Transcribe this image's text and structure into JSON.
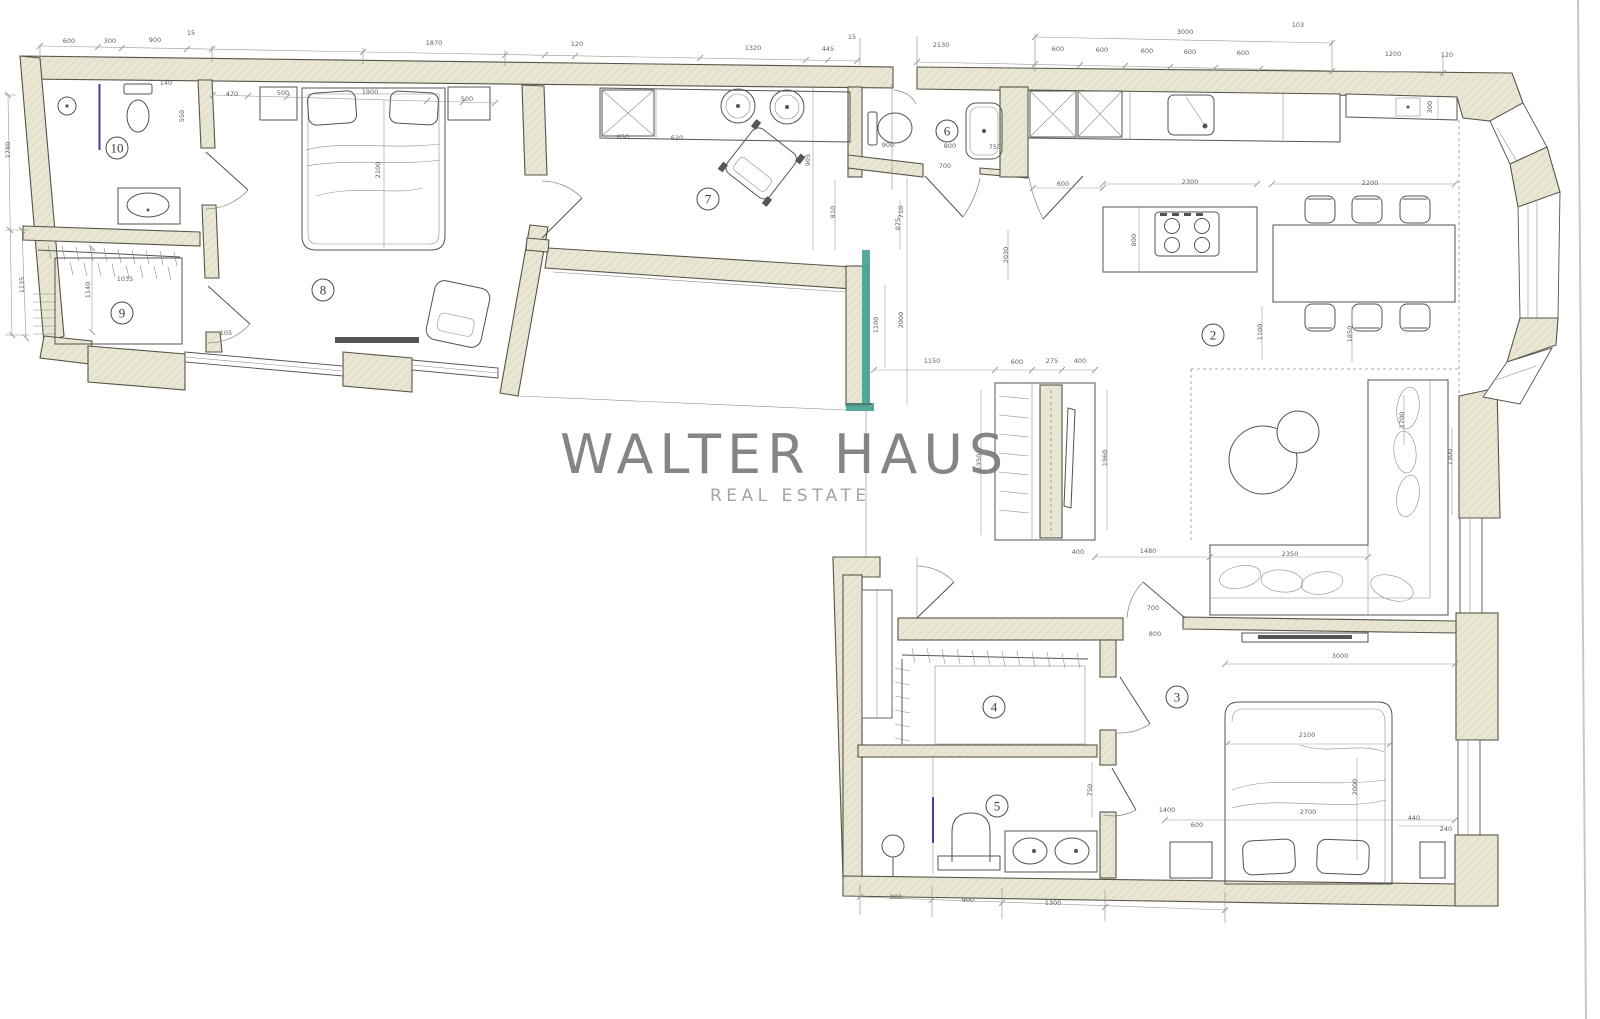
{
  "watermark": {
    "line1": "WALTER HAUS",
    "line2": "REAL ESTATE"
  },
  "colors": {
    "paper": "#ffffff",
    "wall_fill": "#e9e6d3",
    "wall_hatch": "#d5d0b4",
    "wall_stroke": "#56544a",
    "line": "#53534d",
    "thin_line": "#8e8e86",
    "dim_line": "#9b9b93",
    "dim_text": "#60605a",
    "teal_accent": "#43a18f",
    "blue_mark": "#3c3fae",
    "watermark_primary": "#7b7b7b",
    "watermark_secondary": "#9f9f9f",
    "page_edge": "#c9c9c4",
    "room_text": "#3c3c38"
  },
  "room_labels": [
    {
      "n": "10",
      "x": 117,
      "y": 148
    },
    {
      "n": "9",
      "x": 122,
      "y": 313
    },
    {
      "n": "8",
      "x": 323,
      "y": 290
    },
    {
      "n": "7",
      "x": 708,
      "y": 199
    },
    {
      "n": "6",
      "x": 947,
      "y": 131
    },
    {
      "n": "2",
      "x": 1213,
      "y": 335
    },
    {
      "n": "4",
      "x": 994,
      "y": 707
    },
    {
      "n": "5",
      "x": 997,
      "y": 806
    },
    {
      "n": "3",
      "x": 1177,
      "y": 697
    }
  ],
  "dimensions": [
    {
      "t": "600",
      "x": 69,
      "y": 43
    },
    {
      "t": "300",
      "x": 110,
      "y": 43
    },
    {
      "t": "900",
      "x": 155,
      "y": 42
    },
    {
      "t": "15",
      "x": 191,
      "y": 35
    },
    {
      "t": "1870",
      "x": 434,
      "y": 45
    },
    {
      "t": "120",
      "x": 577,
      "y": 46
    },
    {
      "t": "1320",
      "x": 753,
      "y": 50
    },
    {
      "t": "445",
      "x": 828,
      "y": 51
    },
    {
      "t": "15",
      "x": 852,
      "y": 39
    },
    {
      "t": "2130",
      "x": 941,
      "y": 47
    },
    {
      "t": "103",
      "x": 1298,
      "y": 27
    },
    {
      "t": "3000",
      "x": 1185,
      "y": 34
    },
    {
      "t": "600",
      "x": 1058,
      "y": 51
    },
    {
      "t": "600",
      "x": 1102,
      "y": 52
    },
    {
      "t": "600",
      "x": 1147,
      "y": 53
    },
    {
      "t": "600",
      "x": 1190,
      "y": 54
    },
    {
      "t": "600",
      "x": 1243,
      "y": 55
    },
    {
      "t": "1200",
      "x": 1393,
      "y": 56
    },
    {
      "t": "120",
      "x": 1447,
      "y": 57
    },
    {
      "t": "300",
      "x": 1432,
      "y": 107,
      "r": -90
    },
    {
      "t": "1780",
      "x": 10,
      "y": 150,
      "r": -90
    },
    {
      "t": "1135",
      "x": 24,
      "y": 285,
      "r": -90
    },
    {
      "t": "1140",
      "x": 90,
      "y": 290,
      "r": -90
    },
    {
      "t": "140",
      "x": 166,
      "y": 85
    },
    {
      "t": "550",
      "x": 184,
      "y": 116,
      "r": -90
    },
    {
      "t": "1035",
      "x": 125,
      "y": 281
    },
    {
      "t": "470",
      "x": 232,
      "y": 96
    },
    {
      "t": "500",
      "x": 283,
      "y": 95
    },
    {
      "t": "1900",
      "x": 370,
      "y": 94
    },
    {
      "t": "500",
      "x": 467,
      "y": 101
    },
    {
      "t": "2100",
      "x": 380,
      "y": 170,
      "r": -90
    },
    {
      "t": "105",
      "x": 226,
      "y": 335
    },
    {
      "t": "650",
      "x": 623,
      "y": 139
    },
    {
      "t": "620",
      "x": 677,
      "y": 140
    },
    {
      "t": "905",
      "x": 810,
      "y": 160,
      "r": -90
    },
    {
      "t": "810",
      "x": 835,
      "y": 212,
      "r": -90
    },
    {
      "t": "875",
      "x": 900,
      "y": 224,
      "r": -90
    },
    {
      "t": "900",
      "x": 888,
      "y": 147
    },
    {
      "t": "800",
      "x": 950,
      "y": 148
    },
    {
      "t": "750",
      "x": 995,
      "y": 149
    },
    {
      "t": "700",
      "x": 945,
      "y": 168
    },
    {
      "t": "2030",
      "x": 1008,
      "y": 255,
      "r": -90
    },
    {
      "t": "710",
      "x": 903,
      "y": 212,
      "r": -90
    },
    {
      "t": "2000",
      "x": 903,
      "y": 320,
      "r": -90
    },
    {
      "t": "1100",
      "x": 878,
      "y": 325,
      "r": -90
    },
    {
      "t": "1150",
      "x": 932,
      "y": 363
    },
    {
      "t": "600",
      "x": 1017,
      "y": 364
    },
    {
      "t": "275",
      "x": 1052,
      "y": 363
    },
    {
      "t": "400",
      "x": 1080,
      "y": 363
    },
    {
      "t": "1950",
      "x": 981,
      "y": 462,
      "r": -90
    },
    {
      "t": "1960",
      "x": 1107,
      "y": 458,
      "r": -90
    },
    {
      "t": "400",
      "x": 1078,
      "y": 554
    },
    {
      "t": "1480",
      "x": 1148,
      "y": 553
    },
    {
      "t": "2350",
      "x": 1290,
      "y": 556
    },
    {
      "t": "600",
      "x": 1063,
      "y": 186
    },
    {
      "t": "2300",
      "x": 1190,
      "y": 184
    },
    {
      "t": "2200",
      "x": 1370,
      "y": 185
    },
    {
      "t": "800",
      "x": 1136,
      "y": 240,
      "r": -90
    },
    {
      "t": "1100",
      "x": 1262,
      "y": 332,
      "r": -90
    },
    {
      "t": "1850",
      "x": 1352,
      "y": 334,
      "r": -90
    },
    {
      "t": "1300",
      "x": 1452,
      "y": 457,
      "r": -90
    },
    {
      "t": "1700",
      "x": 1404,
      "y": 420,
      "r": -90
    },
    {
      "t": "3000",
      "x": 1340,
      "y": 658
    },
    {
      "t": "2100",
      "x": 1307,
      "y": 737
    },
    {
      "t": "2700",
      "x": 1308,
      "y": 814
    },
    {
      "t": "1400",
      "x": 1167,
      "y": 812
    },
    {
      "t": "600",
      "x": 1197,
      "y": 827
    },
    {
      "t": "2000",
      "x": 1357,
      "y": 787,
      "r": -90
    },
    {
      "t": "440",
      "x": 1414,
      "y": 820
    },
    {
      "t": "240",
      "x": 1446,
      "y": 831
    },
    {
      "t": "700",
      "x": 1153,
      "y": 610
    },
    {
      "t": "800",
      "x": 1155,
      "y": 636
    },
    {
      "t": "750",
      "x": 1092,
      "y": 790,
      "r": -90
    },
    {
      "t": "800",
      "x": 896,
      "y": 899
    },
    {
      "t": "900",
      "x": 968,
      "y": 902
    },
    {
      "t": "1300",
      "x": 1053,
      "y": 905
    }
  ]
}
